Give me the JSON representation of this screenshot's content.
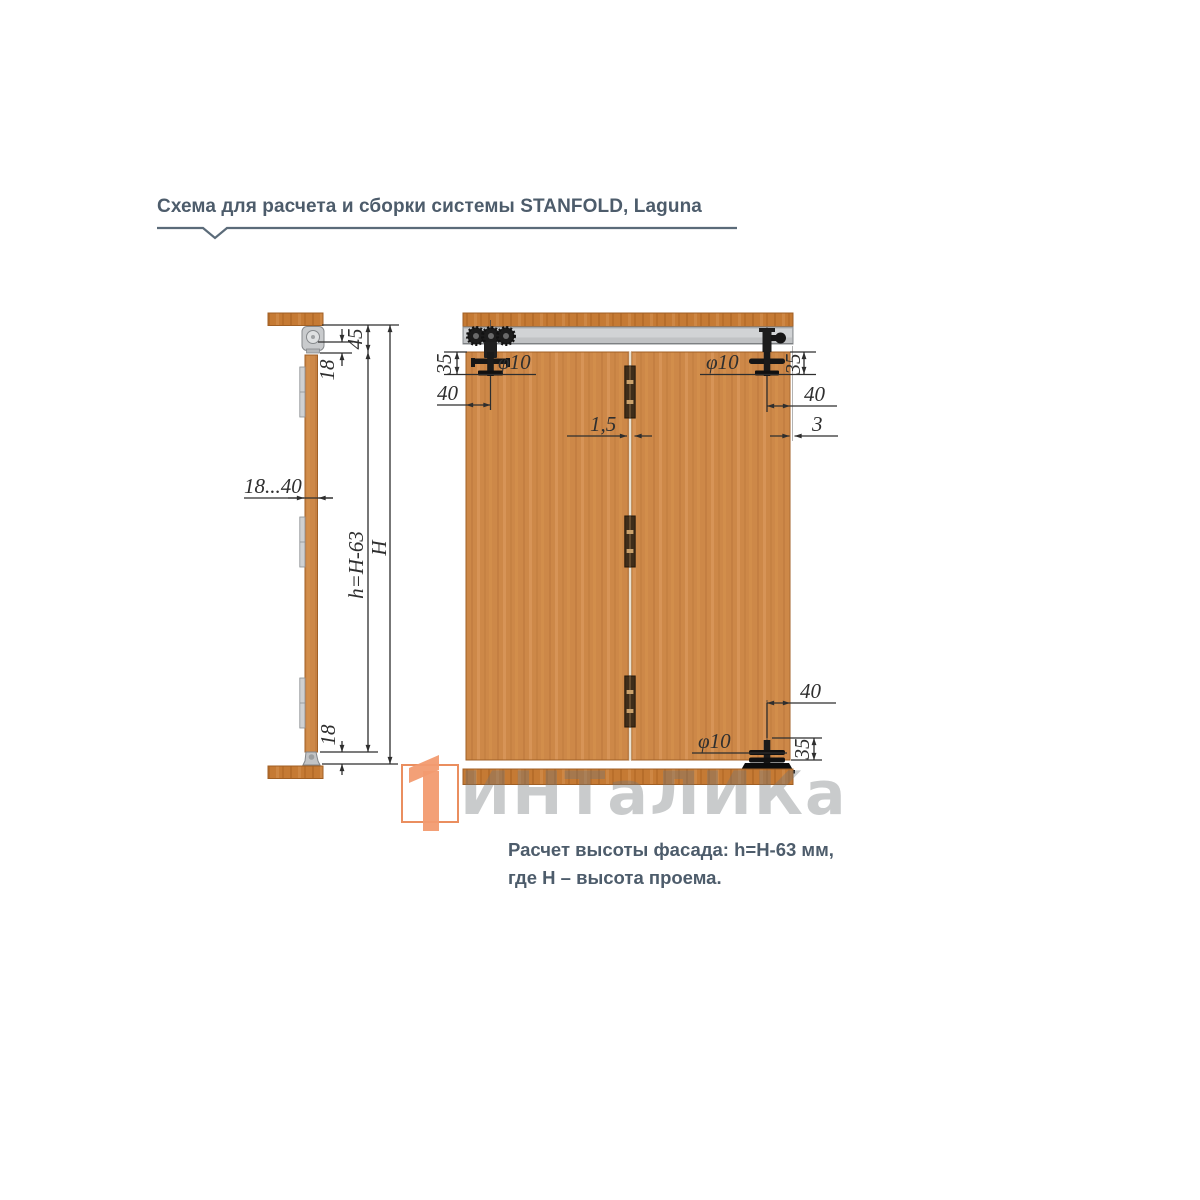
{
  "header": {
    "title": "Схема для расчета и сборки системы STANFOLD, Laguna"
  },
  "side_view": {
    "dims": {
      "top_gap": "45",
      "pin_to_top": "18",
      "door_thickness": "18...40",
      "facade_height": "h=H-63",
      "opening_height": "H",
      "bottom_gap": "18"
    }
  },
  "front_view": {
    "dims": {
      "top_left_hole_depth": "35",
      "top_left_hole_dia": "φ10",
      "top_left_hole_inset": "40",
      "panel_gap": "1,5",
      "top_right_hole_dia": "φ10",
      "top_right_hole_depth": "35",
      "top_right_hole_inset": "40",
      "side_clearance": "3",
      "bottom_hole_inset": "40",
      "bottom_hole_dia": "φ10",
      "bottom_hole_depth": "35"
    }
  },
  "watermark": {
    "text": "ИНТаЛИКа"
  },
  "caption": {
    "line1": "Расчет высоты фасада: h=H-63 мм,",
    "line2": "где H – высота проема."
  },
  "colors": {
    "text_blue": "#4d5c6b",
    "wood_main": "#cd8848",
    "wood_dark": "#a05f24",
    "rail_wood": "#c57a34",
    "track_gray": "#c0c2c4",
    "dim_line": "#2e2e2e",
    "watermark_gray": "#70757a",
    "logo_orange": "#f29b70"
  }
}
